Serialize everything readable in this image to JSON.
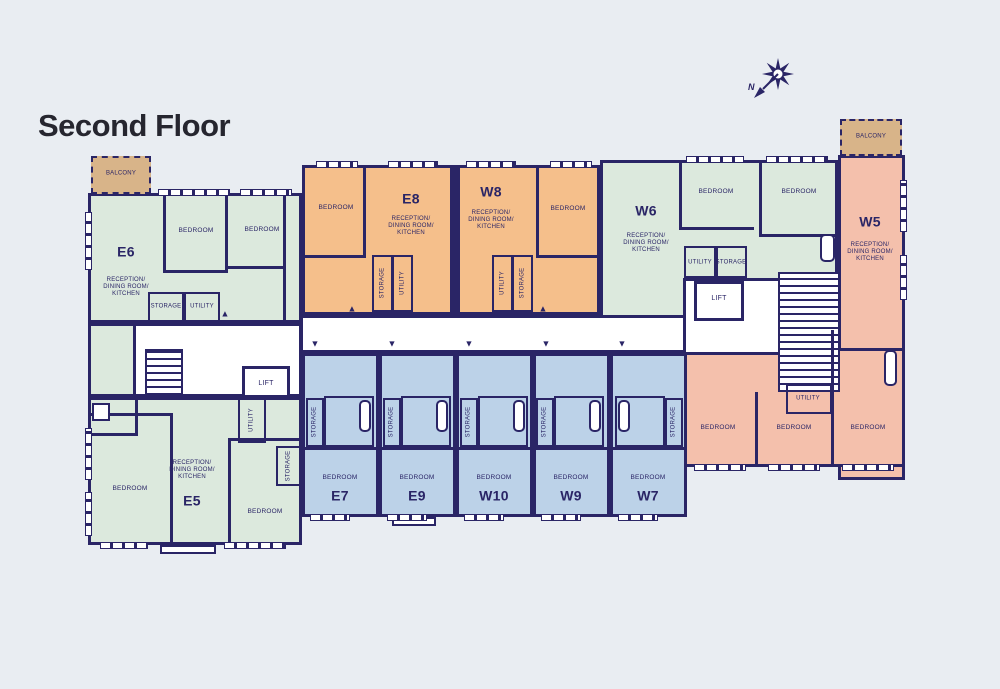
{
  "title": "Second Floor",
  "compass": {
    "label": "N"
  },
  "labels": {
    "balcony": "BALCONY",
    "bedroom": "BEDROOM",
    "storage": "STORAGE",
    "utility": "UTILITY",
    "lift": "LIFT",
    "reception_lines": [
      "RECEPTION/",
      "DINING ROOM/",
      "KITCHEN"
    ]
  },
  "icons": {
    "arrow_up": "▲",
    "arrow_down": "▼"
  },
  "units": {
    "e5": {
      "id": "E5"
    },
    "e6": {
      "id": "E6"
    },
    "e7": {
      "id": "E7"
    },
    "e8": {
      "id": "E8"
    },
    "e9": {
      "id": "E9"
    },
    "w5": {
      "id": "W5"
    },
    "w6": {
      "id": "W6"
    },
    "w7": {
      "id": "W7"
    },
    "w8": {
      "id": "W8"
    },
    "w9": {
      "id": "W9"
    },
    "w10": {
      "id": "W10"
    }
  },
  "colors": {
    "wall": "#2a2566",
    "green": "#dce9dd",
    "orange": "#f5bf8b",
    "blue": "#bcd2e8",
    "salmon": "#f4c0ac",
    "tan": "#d8b489",
    "background": "#e9edf2",
    "corridor": "#ffffff",
    "title": "#26262f"
  }
}
